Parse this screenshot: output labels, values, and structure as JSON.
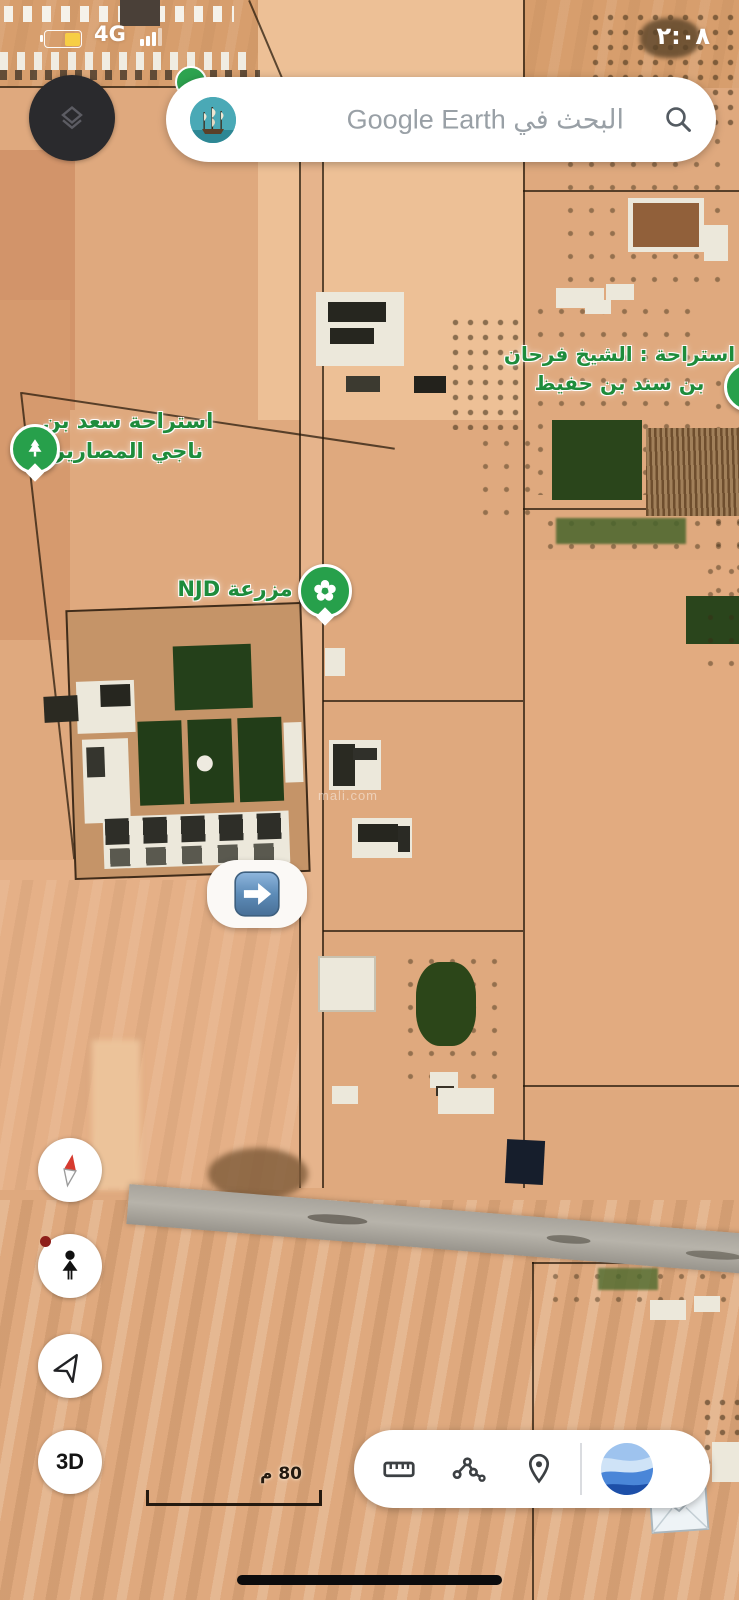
{
  "status_bar": {
    "time": "٢:٠٨",
    "network": "4G"
  },
  "search": {
    "placeholder": "البحث في Google Earth"
  },
  "map_labels": {
    "saad": {
      "line1": "استراحة سعد بن",
      "line2": "ناجي المصارير"
    },
    "sheikh": {
      "line1": "استراحة : الشيخ فرحان",
      "line2": "بن سند بن حفيظ"
    },
    "njd": {
      "text": "مزرعة NJD"
    }
  },
  "watermark": {
    "text": "mali.com"
  },
  "controls": {
    "three_d": "3D"
  },
  "scale": {
    "label": "80 م"
  },
  "colors": {
    "label_green": "#1e8c3c",
    "pin_green": "#27a04b",
    "marker_blue": "#4a7fb5",
    "battery_yellow": "#f7ce45",
    "sand": "#dfa97e"
  }
}
